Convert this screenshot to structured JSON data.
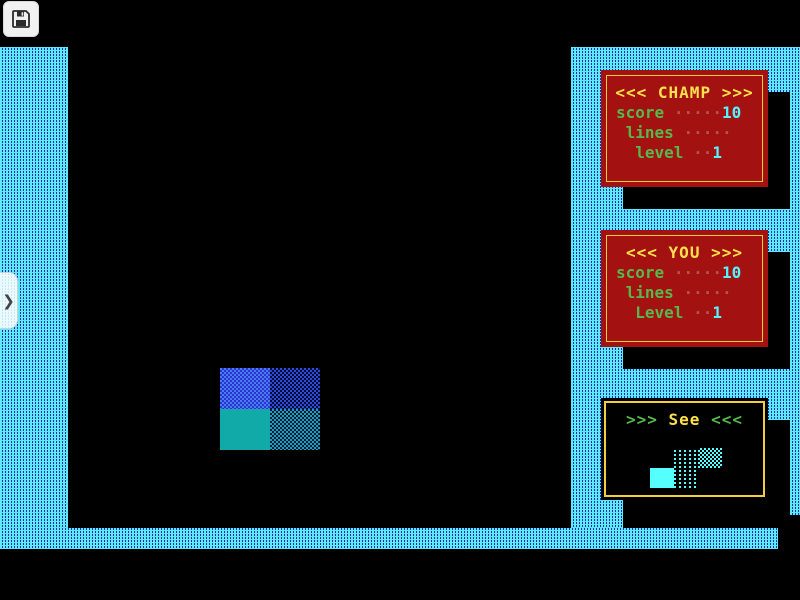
{
  "overlay": {
    "save_button": {
      "icon": "floppy-disk"
    },
    "side_tab": {
      "icon": "chevron-right",
      "chevron_char": "❯"
    }
  },
  "panels": {
    "champ": {
      "title": "<<< CHAMP >>>",
      "rows": [
        {
          "label": "score",
          "dots": "·····",
          "value": "10"
        },
        {
          "label": " lines",
          "dots": "·····",
          "value": ""
        },
        {
          "label": "  level",
          "dots": "··",
          "value": "1"
        }
      ]
    },
    "you": {
      "title": "<<< YOU >>>",
      "rows": [
        {
          "label": "score",
          "dots": "·····",
          "value": "10"
        },
        {
          "label": " lines",
          "dots": "·····",
          "value": ""
        },
        {
          "label": "  Level",
          "dots": "··",
          "value": "1"
        }
      ]
    },
    "see": {
      "arrows_left": ">>>",
      "word": " See ",
      "arrows_right": "<<<"
    }
  },
  "game": {
    "field_piece": {
      "rows": 2,
      "cols": 2,
      "top_color": "#2a35d0",
      "bottom_color": "#12a9a9",
      "textures": [
        "blue-light-dither",
        "blue-dark-dither",
        "teal-solid",
        "teal-dark-dither"
      ]
    },
    "next_piece": {
      "shape": "S",
      "color": "#55ffff"
    }
  },
  "colors": {
    "pattern_cyan": "#5fe9f9",
    "pattern_blue": "#0d2fb3",
    "panel_red": "#a31111",
    "panel_border_yellow": "#f2ce3c",
    "title_yellow": "#ffe14d",
    "label_green": "#58b84c",
    "value_cyan": "#55f5ff",
    "dots_maroon": "#b25454",
    "background": "#000000"
  }
}
